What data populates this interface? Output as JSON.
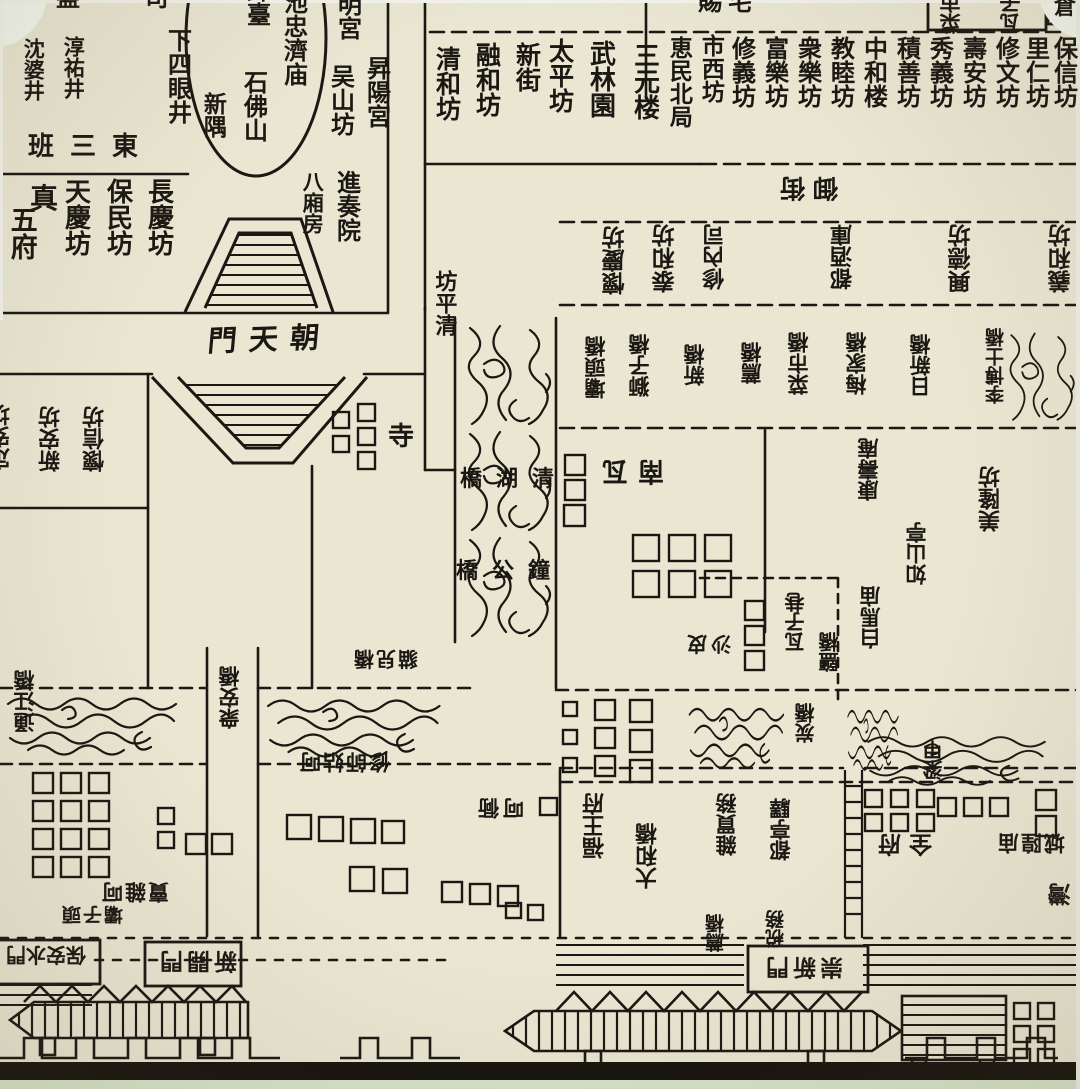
{
  "map": {
    "palette": {
      "paper": "#e9e6d2",
      "ink": "#1b1712",
      "photo_edge_white": "#f4f6ee",
      "photo_bottom_green": "#d6e4ca",
      "bottom_bar_black": "#17130e"
    },
    "labels": [
      {
        "name": "partial-top-si",
        "text": "盤 司",
        "x": 56,
        "y": -14,
        "size": 24,
        "mode": "h",
        "ls": 28
      },
      {
        "name": "shen-po-jing",
        "text": "沈婆井",
        "x": 22,
        "y": 38,
        "size": 21,
        "mode": "v"
      },
      {
        "name": "chun-you-jing",
        "text": "淳祐井",
        "x": 62,
        "y": 36,
        "size": 21,
        "mode": "v"
      },
      {
        "name": "xia-si-yan-jing",
        "text": "下四眼井",
        "x": 164,
        "y": 28,
        "size": 24,
        "mode": "v"
      },
      {
        "name": "tai-partial",
        "text": "鉢臺",
        "x": 243,
        "y": -22,
        "size": 24,
        "mode": "v"
      },
      {
        "name": "chi-zhong-ji-miao",
        "text": "池忠濟庙",
        "x": 280,
        "y": -10,
        "size": 24,
        "mode": "v"
      },
      {
        "name": "ming-gong-partial",
        "text": "明宮",
        "x": 334,
        "y": -8,
        "size": 24,
        "mode": "v"
      },
      {
        "name": "xin-yu",
        "text": "新隅",
        "x": 200,
        "y": 92,
        "size": 23,
        "mode": "v"
      },
      {
        "name": "shi-fo-shan",
        "text": "石佛山",
        "x": 240,
        "y": 70,
        "size": 24,
        "mode": "v"
      },
      {
        "name": "wu-shan-fang",
        "text": "吴山坊",
        "x": 327,
        "y": 64,
        "size": 24,
        "mode": "v"
      },
      {
        "name": "sheng-yang-gong",
        "text": "昇陽宮",
        "x": 363,
        "y": 56,
        "size": 24,
        "mode": "v"
      },
      {
        "name": "dong-san-ban",
        "text": "班三東",
        "x": 28,
        "y": 134,
        "size": 26,
        "mode": "h",
        "ls": 16
      },
      {
        "name": "chang-qing-fang",
        "text": "長慶坊",
        "x": 144,
        "y": 178,
        "size": 26,
        "mode": "v"
      },
      {
        "name": "bao-min-fang",
        "text": "保民坊",
        "x": 103,
        "y": 178,
        "size": 26,
        "mode": "v"
      },
      {
        "name": "tian-qing-fang",
        "text": "天慶坊",
        "x": 61,
        "y": 178,
        "size": 26,
        "mode": "v"
      },
      {
        "name": "zhen",
        "text": "真",
        "x": 30,
        "y": 184,
        "size": 28,
        "mode": "h"
      },
      {
        "name": "wu-fu",
        "text": "五府",
        "x": 6,
        "y": 206,
        "size": 27,
        "mode": "v"
      },
      {
        "name": "jin-zou-yuan",
        "text": "進奏院",
        "x": 333,
        "y": 170,
        "size": 24,
        "mode": "v"
      },
      {
        "name": "ba-xiang-fang",
        "text": "八廂房",
        "x": 301,
        "y": 171,
        "size": 21,
        "mode": "v"
      },
      {
        "name": "chao-tian-men",
        "text": "門天朝",
        "x": 208,
        "y": 324,
        "size": 29,
        "mode": "hskew",
        "ls": 12
      },
      {
        "name": "ci-zhai-partial",
        "text": "賜宅",
        "x": 698,
        "y": -10,
        "size": 24,
        "mode": "h",
        "ls": 6
      },
      {
        "name": "box-cai-shi",
        "text": "菜市",
        "x": 940,
        "y": -8,
        "size": 21,
        "mode": "v180"
      },
      {
        "name": "box-wa-zi",
        "text": "瓦子",
        "x": 1000,
        "y": -8,
        "size": 21,
        "mode": "v180"
      },
      {
        "name": "cang-partial",
        "text": "倉",
        "x": 1054,
        "y": -4,
        "size": 22,
        "mode": "h"
      },
      {
        "name": "qing-he-fang",
        "text": "清和坊",
        "x": 433,
        "y": 46,
        "size": 25,
        "mode": "v"
      },
      {
        "name": "rong-he-fang",
        "text": "融和坊",
        "x": 473,
        "y": 42,
        "size": 25,
        "mode": "v"
      },
      {
        "name": "xin-jie",
        "text": "新街",
        "x": 513,
        "y": 42,
        "size": 25,
        "mode": "v"
      },
      {
        "name": "tai-ping-fang",
        "text": "太平坊",
        "x": 546,
        "y": 38,
        "size": 25,
        "mode": "v"
      },
      {
        "name": "wu-lin-yuan",
        "text": "武林園",
        "x": 586,
        "y": 40,
        "size": 26,
        "mode": "v"
      },
      {
        "name": "san-yuan-lou",
        "text": "三元楼",
        "x": 630,
        "y": 42,
        "size": 26,
        "mode": "v"
      },
      {
        "name": "hui-min-bei-ju",
        "text": "恵民北局",
        "x": 666,
        "y": 36,
        "size": 23,
        "mode": "v"
      },
      {
        "name": "shi-xi-fang",
        "text": "市西坊",
        "x": 698,
        "y": 34,
        "size": 23,
        "mode": "v"
      },
      {
        "name": "xiu-yi-fang",
        "text": "修義坊",
        "x": 728,
        "y": 36,
        "size": 24,
        "mode": "v"
      },
      {
        "name": "fu-le-fang",
        "text": "富樂坊",
        "x": 761,
        "y": 36,
        "size": 24,
        "mode": "v"
      },
      {
        "name": "zhong-le-fang",
        "text": "衆樂坊",
        "x": 794,
        "y": 36,
        "size": 24,
        "mode": "v"
      },
      {
        "name": "jiao-mu-fang",
        "text": "教睦坊",
        "x": 827,
        "y": 36,
        "size": 24,
        "mode": "v"
      },
      {
        "name": "zhong-he-lou",
        "text": "中和楼",
        "x": 860,
        "y": 36,
        "size": 24,
        "mode": "v"
      },
      {
        "name": "ji-shan-fang",
        "text": "積善坊",
        "x": 893,
        "y": 36,
        "size": 24,
        "mode": "v"
      },
      {
        "name": "xiu-yi2-fang",
        "text": "秀義坊",
        "x": 926,
        "y": 36,
        "size": 24,
        "mode": "v"
      },
      {
        "name": "shou-an-fang",
        "text": "壽安坊",
        "x": 959,
        "y": 36,
        "size": 24,
        "mode": "v"
      },
      {
        "name": "xiu-wen-fang",
        "text": "修文坊",
        "x": 992,
        "y": 36,
        "size": 24,
        "mode": "v"
      },
      {
        "name": "li-ren-fang",
        "text": "里仁坊",
        "x": 1022,
        "y": 36,
        "size": 24,
        "mode": "v"
      },
      {
        "name": "bao-xin-fang",
        "text": "保信坊",
        "x": 1050,
        "y": 36,
        "size": 24,
        "mode": "v"
      },
      {
        "name": "yu-jie",
        "text": "御街",
        "x": 772,
        "y": 174,
        "size": 25,
        "mode": "h180",
        "ls": 8
      },
      {
        "name": "huai-qing-fang",
        "text": "懷慶坊",
        "x": 604,
        "y": 226,
        "size": 23,
        "mode": "v180"
      },
      {
        "name": "tai-he-fang",
        "text": "泰和坊",
        "x": 654,
        "y": 224,
        "size": 23,
        "mode": "v180"
      },
      {
        "name": "xiu-nei-si",
        "text": "修內司",
        "x": 704,
        "y": 224,
        "size": 22,
        "mode": "v180"
      },
      {
        "name": "du-jiu-ku",
        "text": "都酒庫",
        "x": 832,
        "y": 224,
        "size": 22,
        "mode": "v180"
      },
      {
        "name": "xing-de-fang",
        "text": "興德坊",
        "x": 950,
        "y": 224,
        "size": 23,
        "mode": "v180"
      },
      {
        "name": "yi-he-fang",
        "text": "義和坊",
        "x": 1050,
        "y": 224,
        "size": 23,
        "mode": "v180"
      },
      {
        "name": "ba-tou-qiao",
        "text": "壩頭橋",
        "x": 585,
        "y": 336,
        "size": 21,
        "mode": "v180"
      },
      {
        "name": "shi-zi-qiao",
        "text": "獅子橋",
        "x": 629,
        "y": 334,
        "size": 21,
        "mode": "v180"
      },
      {
        "name": "xin-qiao",
        "text": "新橋",
        "x": 684,
        "y": 344,
        "size": 21,
        "mode": "v180"
      },
      {
        "name": "jian-qiao",
        "text": "薦橋",
        "x": 741,
        "y": 342,
        "size": 21,
        "mode": "v180"
      },
      {
        "name": "cai-shi-qiao",
        "text": "菜市橋",
        "x": 788,
        "y": 332,
        "size": 21,
        "mode": "v180"
      },
      {
        "name": "mei-jia-qiao",
        "text": "梅家橋",
        "x": 846,
        "y": 332,
        "size": 21,
        "mode": "v180"
      },
      {
        "name": "ri-xin-qiao",
        "text": "日新橋",
        "x": 910,
        "y": 334,
        "size": 21,
        "mode": "v180"
      },
      {
        "name": "li-bo-shi-qiao",
        "text": "李博士橋",
        "x": 986,
        "y": 328,
        "size": 19,
        "mode": "v180"
      },
      {
        "name": "qing-ping-fang",
        "text": "坊平清",
        "x": 432,
        "y": 270,
        "size": 22,
        "mode": "v"
      },
      {
        "name": "qing-hu-qiao",
        "text": "橋湖清",
        "x": 460,
        "y": 468,
        "size": 22,
        "mode": "h",
        "ls": 14
      },
      {
        "name": "zhong-gong-qiao",
        "text": "橋公鐘",
        "x": 456,
        "y": 560,
        "size": 22,
        "mode": "h",
        "ls": 14
      },
      {
        "name": "nan-wa",
        "text": "南瓦",
        "x": 592,
        "y": 456,
        "size": 26,
        "mode": "h180",
        "ls": 10
      },
      {
        "name": "si-temple",
        "text": "寺",
        "x": 388,
        "y": 424,
        "size": 26,
        "mode": "h"
      },
      {
        "name": "mei-long-fang",
        "text": "美隆坊",
        "x": 980,
        "y": 466,
        "size": 22,
        "mode": "v180"
      },
      {
        "name": "ru-shan-ting",
        "text": "如山亭",
        "x": 906,
        "y": 522,
        "size": 21,
        "mode": "v180"
      },
      {
        "name": "kang-shou-an",
        "text": "康壽庵",
        "x": 858,
        "y": 438,
        "size": 21,
        "mode": "v180"
      },
      {
        "name": "bai-ma-miao",
        "text": "白馬庙",
        "x": 860,
        "y": 586,
        "size": 21,
        "mode": "v180"
      },
      {
        "name": "wa-zi-xiang",
        "text": "瓦子巷",
        "x": 786,
        "y": 592,
        "size": 20,
        "mode": "v180"
      },
      {
        "name": "sha-pi-xiang",
        "text": "沙皮",
        "x": 683,
        "y": 633,
        "size": 20,
        "mode": "h180",
        "ls": 4
      },
      {
        "name": "yan-qiao",
        "text": "鹽橋",
        "x": 820,
        "y": 632,
        "size": 20,
        "mode": "v180"
      },
      {
        "name": "tong-jiang-qiao",
        "text": "通江橋",
        "x": 14,
        "y": 670,
        "size": 21,
        "mode": "v180"
      },
      {
        "name": "zhong-an-qiao",
        "text": "衆安橋",
        "x": 219,
        "y": 666,
        "size": 21,
        "mode": "v180"
      },
      {
        "name": "mao-er-qiao",
        "text": "貓兒橋",
        "x": 352,
        "y": 648,
        "size": 20,
        "mode": "h180",
        "ls": 2
      },
      {
        "name": "tan-qiao",
        "text": "炭橋",
        "x": 796,
        "y": 703,
        "size": 20,
        "mode": "v180"
      },
      {
        "name": "xiu-shi-gu-he",
        "text": "修師姑呵",
        "x": 298,
        "y": 750,
        "size": 21,
        "mode": "h180",
        "ls": 2
      },
      {
        "name": "he-tong",
        "text": "呵衕",
        "x": 474,
        "y": 796,
        "size": 21,
        "mode": "h180",
        "ls": 4
      },
      {
        "name": "mai-za-he",
        "text": "賣雜呵",
        "x": 100,
        "y": 880,
        "size": 21,
        "mode": "h180",
        "ls": 2
      },
      {
        "name": "fu-wang-fu",
        "text": "福王府",
        "x": 584,
        "y": 793,
        "size": 22,
        "mode": "v180"
      },
      {
        "name": "da-he-qiao",
        "text": "大和橋",
        "x": 637,
        "y": 823,
        "size": 22,
        "mode": "v180"
      },
      {
        "name": "za-mai-wu",
        "text": "雜買務",
        "x": 716,
        "y": 793,
        "size": 21,
        "mode": "v180"
      },
      {
        "name": "du-ting-yi",
        "text": "都亭驛",
        "x": 770,
        "y": 798,
        "size": 21,
        "mode": "v180"
      },
      {
        "name": "quan-fu",
        "text": "全府",
        "x": 870,
        "y": 831,
        "size": 23,
        "mode": "h180",
        "ls": 8
      },
      {
        "name": "cheng-huang-miao",
        "text": "城隍庙",
        "x": 996,
        "y": 831,
        "size": 21,
        "mode": "h180",
        "ls": 2
      },
      {
        "name": "liang-jia",
        "text": "梁甲",
        "x": 924,
        "y": 740,
        "size": 20,
        "mode": "v180"
      },
      {
        "name": "wan-partial",
        "text": "灣",
        "x": 1050,
        "y": 883,
        "size": 23,
        "mode": "v180"
      },
      {
        "name": "huai-xin-fang",
        "text": "懷信坊",
        "x": 84,
        "y": 406,
        "size": 22,
        "mode": "v180"
      },
      {
        "name": "xin-an-fang",
        "text": "新安坊",
        "x": 40,
        "y": 406,
        "size": 22,
        "mode": "v180"
      },
      {
        "name": "ding-an-fang-partial",
        "text": "定安坊",
        "x": -10,
        "y": 404,
        "size": 22,
        "mode": "v180"
      },
      {
        "name": "ba-zi-tou",
        "text": "壩子頭",
        "x": 60,
        "y": 904,
        "size": 19,
        "mode": "h180",
        "ls": 2
      },
      {
        "name": "jian-qiao-small",
        "text": "薦橋",
        "x": 706,
        "y": 914,
        "size": 19,
        "mode": "v180"
      },
      {
        "name": "shui-wu",
        "text": "税務",
        "x": 766,
        "y": 910,
        "size": 19,
        "mode": "v180"
      },
      {
        "name": "gate-bao-an-shui-men",
        "text": "保安水門",
        "x": 6,
        "y": 944,
        "size": 20,
        "mode": "h180"
      },
      {
        "name": "gate-xin-kai-men",
        "text": "新開門",
        "x": 156,
        "y": 948,
        "size": 23,
        "mode": "h180",
        "ls": 4
      },
      {
        "name": "gate-chong-xin-men",
        "text": "崇新門",
        "x": 762,
        "y": 954,
        "size": 23,
        "mode": "h180",
        "ls": 4
      }
    ]
  }
}
